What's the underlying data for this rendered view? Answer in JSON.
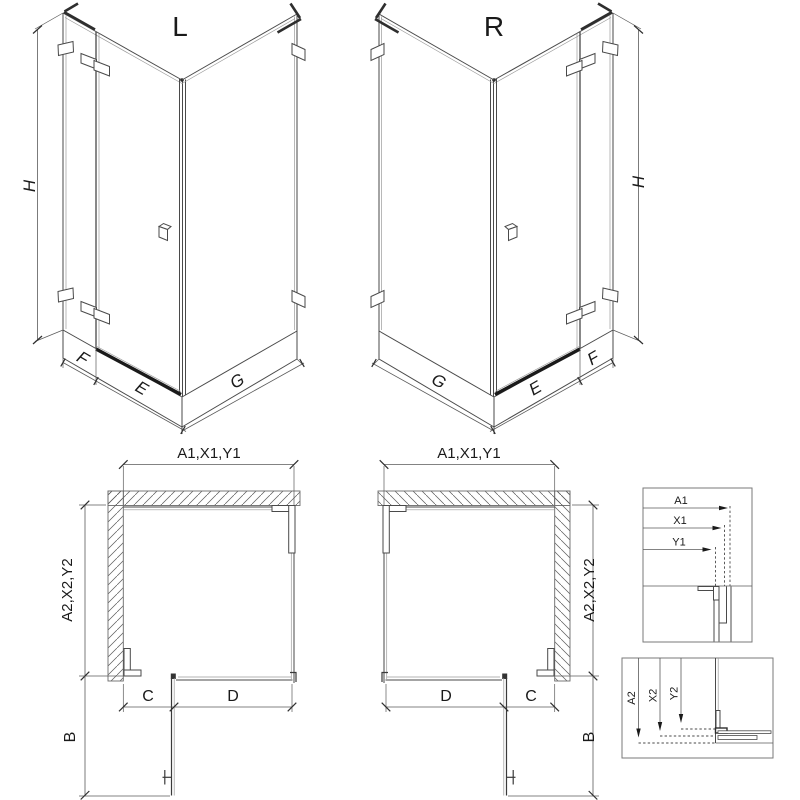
{
  "colors": {
    "background": "#ffffff",
    "line": "#4a4a4a",
    "light_line": "#9a9a9a",
    "threshold_dark": "#1a1a1a",
    "detail_box_border": "#7a7a7a",
    "text": "#1a1a1a"
  },
  "iso_views": {
    "left": {
      "label": "L",
      "dim_height": "H",
      "dim_side_panel": "F",
      "dim_door": "E",
      "dim_back_panel": "G"
    },
    "right": {
      "label": "R",
      "dim_height": "H",
      "dim_side_panel": "F",
      "dim_door": "E",
      "dim_back_panel": "G"
    }
  },
  "plan_views": {
    "left": {
      "dim_width": "A1,X1,Y1",
      "dim_depth": "A2,X2,Y2",
      "dim_c": "C",
      "dim_d": "D",
      "dim_b": "B"
    },
    "right": {
      "dim_width": "A1,X1,Y1",
      "dim_depth": "A2,X2,Y2",
      "dim_c": "C",
      "dim_d": "D",
      "dim_b": "B"
    }
  },
  "detail_views": {
    "top": {
      "dim_a": "A1",
      "dim_x": "X1",
      "dim_y": "Y1"
    },
    "bottom": {
      "dim_a": "A2",
      "dim_x": "X2",
      "dim_y": "Y2"
    }
  }
}
